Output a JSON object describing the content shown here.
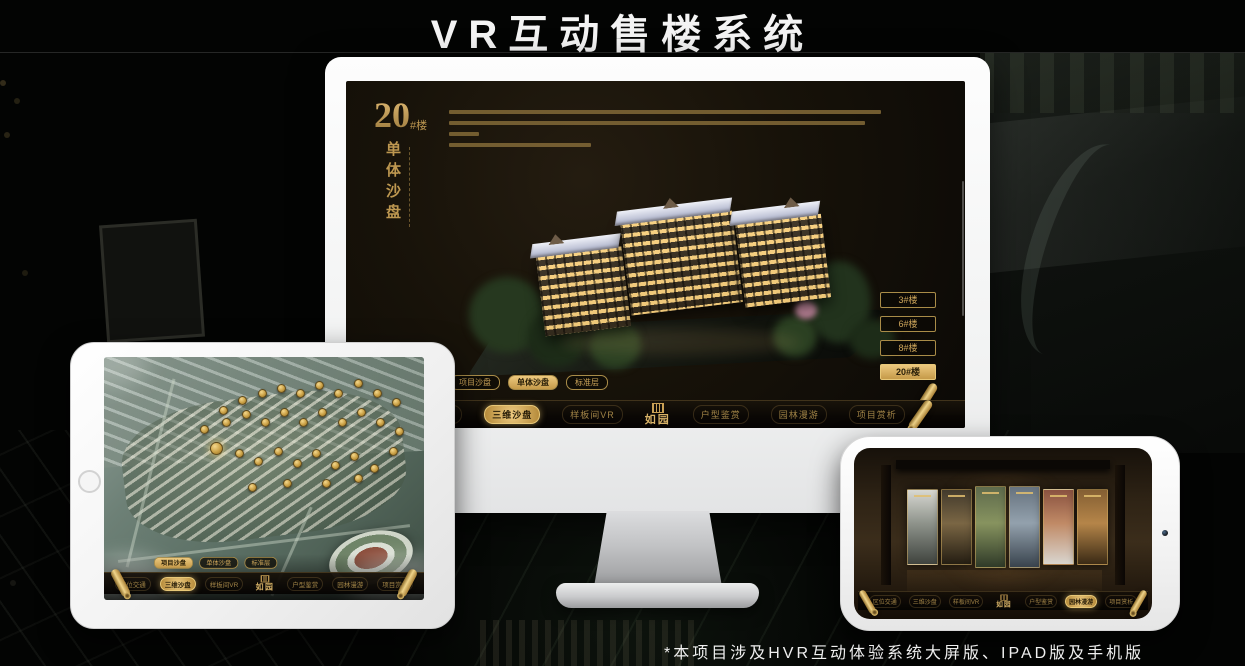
{
  "page": {
    "title": "VR互动售楼系统",
    "footnote": "*本项目涉及HVR互动体验系统大屏版、IPAD版及手机版"
  },
  "colors": {
    "gold": "#c9a155",
    "gold_bright": "#ecc87e",
    "gold_dark": "#7d6535",
    "active_text": "#2b2008",
    "screen_bg": "#171209",
    "monitor_frame": "#f1f2f2",
    "title_white": "#f4f4f4"
  },
  "nav_menu": {
    "logo": "如园",
    "items": [
      "区位交通",
      "三维沙盘",
      "样板间VR",
      "户型鉴赏",
      "园林漫游",
      "项目赏析"
    ]
  },
  "view_tabs": [
    "项目沙盘",
    "单体沙盘",
    "标准层"
  ],
  "desktop": {
    "unit_number": "20",
    "unit_suffix": "#楼",
    "unit_subtitle": "单体沙盘",
    "description_line_widths": [
      432,
      416,
      30,
      142
    ],
    "floor_buttons": [
      "3#楼",
      "6#楼",
      "8#楼",
      "20#楼"
    ],
    "active_floor_index": 3,
    "active_tab_index": 1,
    "active_nav_index": 1
  },
  "tablet": {
    "active_tab_index": 0,
    "active_nav_index": 1,
    "highlight_marker_index": 0,
    "markers": [
      [
        33,
        35
      ],
      [
        36,
        20
      ],
      [
        42,
        16
      ],
      [
        48,
        13
      ],
      [
        54,
        11
      ],
      [
        60,
        13
      ],
      [
        66,
        10
      ],
      [
        72,
        13
      ],
      [
        78,
        9
      ],
      [
        84,
        13
      ],
      [
        90,
        17
      ],
      [
        30,
        28
      ],
      [
        37,
        25
      ],
      [
        43,
        22
      ],
      [
        49,
        25
      ],
      [
        55,
        21
      ],
      [
        61,
        25
      ],
      [
        67,
        21
      ],
      [
        73,
        25
      ],
      [
        79,
        21
      ],
      [
        85,
        25
      ],
      [
        91,
        29
      ],
      [
        41,
        38
      ],
      [
        47,
        41
      ],
      [
        53,
        37
      ],
      [
        59,
        42
      ],
      [
        65,
        38
      ],
      [
        71,
        43
      ],
      [
        77,
        39
      ],
      [
        83,
        44
      ],
      [
        89,
        37
      ],
      [
        45,
        52
      ],
      [
        56,
        50
      ],
      [
        68,
        50
      ],
      [
        78,
        48
      ]
    ]
  },
  "phone": {
    "active_nav_index": 4,
    "gallery_cards": [
      {
        "colors": [
          "#d8d8d2",
          "#8e938b",
          "#3f433e"
        ]
      },
      {
        "colors": [
          "#423a2c",
          "#7a6644",
          "#241d12"
        ]
      },
      {
        "colors": [
          "#5e6a4c",
          "#87935f",
          "#2f3a28"
        ]
      },
      {
        "colors": [
          "#66727e",
          "#93a1ad",
          "#39434d"
        ]
      },
      {
        "colors": [
          "#8a5240",
          "#c08a66",
          "#d9d5cf"
        ]
      },
      {
        "colors": [
          "#845f33",
          "#b58549",
          "#3a2a15"
        ]
      }
    ]
  }
}
